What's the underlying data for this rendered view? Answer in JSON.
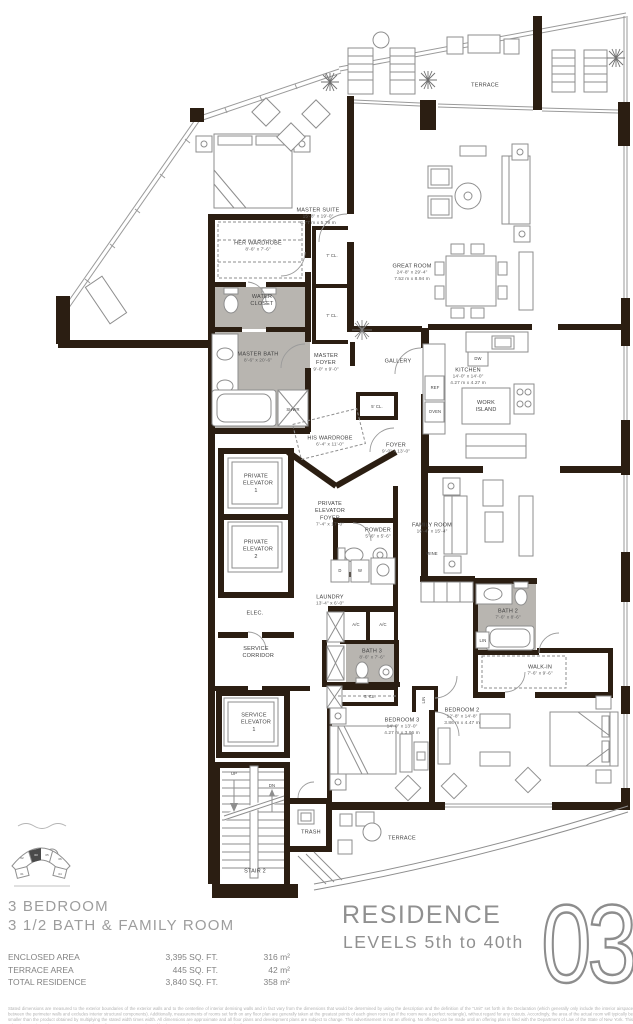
{
  "plan": {
    "rooms": {
      "terrace_top": {
        "name": "TERRACE"
      },
      "master_suite": {
        "name": "MASTER SUITE",
        "dim_ft": "15'-8\" x 19'-0\"",
        "dim_m": "4.77 m x 5.79 m"
      },
      "her_wardrobe": {
        "name": "HER WARDROBE",
        "dim_ft": "8'-6\" x 7'-6\""
      },
      "water_closet": {
        "name": "WATER CLOSET"
      },
      "great_room": {
        "name": "GREAT ROOM",
        "dim_ft": "24'-8\" x 29'-4\"",
        "dim_m": "7.52 m x 8.94 m"
      },
      "master_bath": {
        "name": "MASTER BATH",
        "dim_ft": "8'-6\" x 20'-6\""
      },
      "master_foyer": {
        "name": "MASTER FOYER",
        "dim_ft": "9'-0\" x 9'-0\""
      },
      "gallery": {
        "name": "GALLERY"
      },
      "kitchen": {
        "name": "KITCHEN",
        "dim_ft": "14'-0\" x 14'-0\"",
        "dim_m": "4.27 m x 4.27 m"
      },
      "work_island": {
        "name": "WORK ISLAND"
      },
      "his_wardrobe": {
        "name": "HIS WARDROBE",
        "dim_ft": "6'-4\" x 11'-0\""
      },
      "foyer": {
        "name": "FOYER",
        "dim_ft": "9'-0\" x 13'-0\""
      },
      "pe1": {
        "name": "PRIVATE ELEVATOR 1"
      },
      "pe2": {
        "name": "PRIVATE ELEVATOR 2"
      },
      "pe_foyer": {
        "name": "PRIVATE ELEVATOR FOYER",
        "dim_ft": "7'-4\" x 17'-0\""
      },
      "powder": {
        "name": "POWDER",
        "dim_ft": "5'-6\" x 5'-6\""
      },
      "family_room": {
        "name": "FAMILY ROOM",
        "dim_ft": "16'-4\" x 15'-4\""
      },
      "wine": {
        "name": "WINE"
      },
      "laundry": {
        "name": "LAUNDRY",
        "dim_ft": "13'-4\" x 6'-0\""
      },
      "elec": {
        "name": "ELEC."
      },
      "service_corridor": {
        "name": "SERVICE CORRIDOR"
      },
      "bath3": {
        "name": "BATH 3",
        "dim_ft": "8'-6\" x 7'-6\""
      },
      "bath2": {
        "name": "BATH 2",
        "dim_ft": "7'-6\" x 8'-6\""
      },
      "walk_in": {
        "name": "WALK-IN",
        "dim_ft": "7'-6\" x 9'-6\""
      },
      "bedroom3": {
        "name": "BEDROOM 3",
        "dim_ft": "14'-0\" x 13'-0\"",
        "dim_m": "4.27 m x 3.96 m"
      },
      "bedroom2": {
        "name": "BEDROOM 2",
        "dim_ft": "12'-8\" x 14'-8\"",
        "dim_m": "3.86 m x 4.47 m"
      },
      "service_elevator": {
        "name": "SERVICE ELEVATOR 1"
      },
      "stair2": {
        "name": "STAIR 2"
      },
      "trash": {
        "name": "TRASH"
      },
      "terrace_bottom": {
        "name": "TERRACE"
      }
    },
    "small": {
      "cl7": "7' CL.",
      "cl5": "5' CL.",
      "dw": "DW",
      "ref": "REF",
      "oven": "OVEN",
      "shwr": "SHWR",
      "d": "D",
      "w": "W",
      "ac": "A/C",
      "lin": "LIN",
      "up": "UP",
      "dn": "DN"
    }
  },
  "key_plan": {
    "residences": [
      "02",
      "03",
      "05",
      "06",
      "01",
      "04"
    ],
    "highlighted": "03"
  },
  "footer": {
    "title_line1": "3 BEDROOM",
    "title_line2": "3 1/2 BATH & FAMILY ROOM",
    "areas": [
      {
        "label": "ENCLOSED AREA",
        "sqft": "3,395 SQ. FT.",
        "metric": "316 m²"
      },
      {
        "label": "TERRACE AREA",
        "sqft": "445 SQ. FT.",
        "metric": "42 m²"
      },
      {
        "label": "TOTAL RESIDENCE",
        "sqft": "3,840 SQ. FT.",
        "metric": "358 m²"
      }
    ],
    "residence_word": "RESIDENCE",
    "levels": "LEVELS 5th to 40th",
    "unit_number": "03",
    "disclaimer": "Stated dimensions are measured to the exterior boundaries of the exterior walls and to the centerline of interior demising walls and in fact vary from the dimensions that would be determined by using the description and the definition of the \"Unit\" set forth in the Declaration (which generally only include the interior airspace between the perimeter walls and excludes interior structural components). Additionally, measurements of rooms set forth on any floor plan are generally taken at the greatest points of each given room (as if the room were a perfect rectangle), without regard for any cutouts. Accordingly, the area of the actual room will typically be smaller than the product obtained by multiplying the stated width times width. All dimensions are approximate and all floor plans and development plans are subject to change. This advertisement is not an offering. No offering can be made until an offering plan is filed with the Department of Law of the State of New York. This advertisement is made pursuant to Cooperative Policy Statement No. 1, issued by the New York State Attorney General. File No. CP08-0093."
  }
}
